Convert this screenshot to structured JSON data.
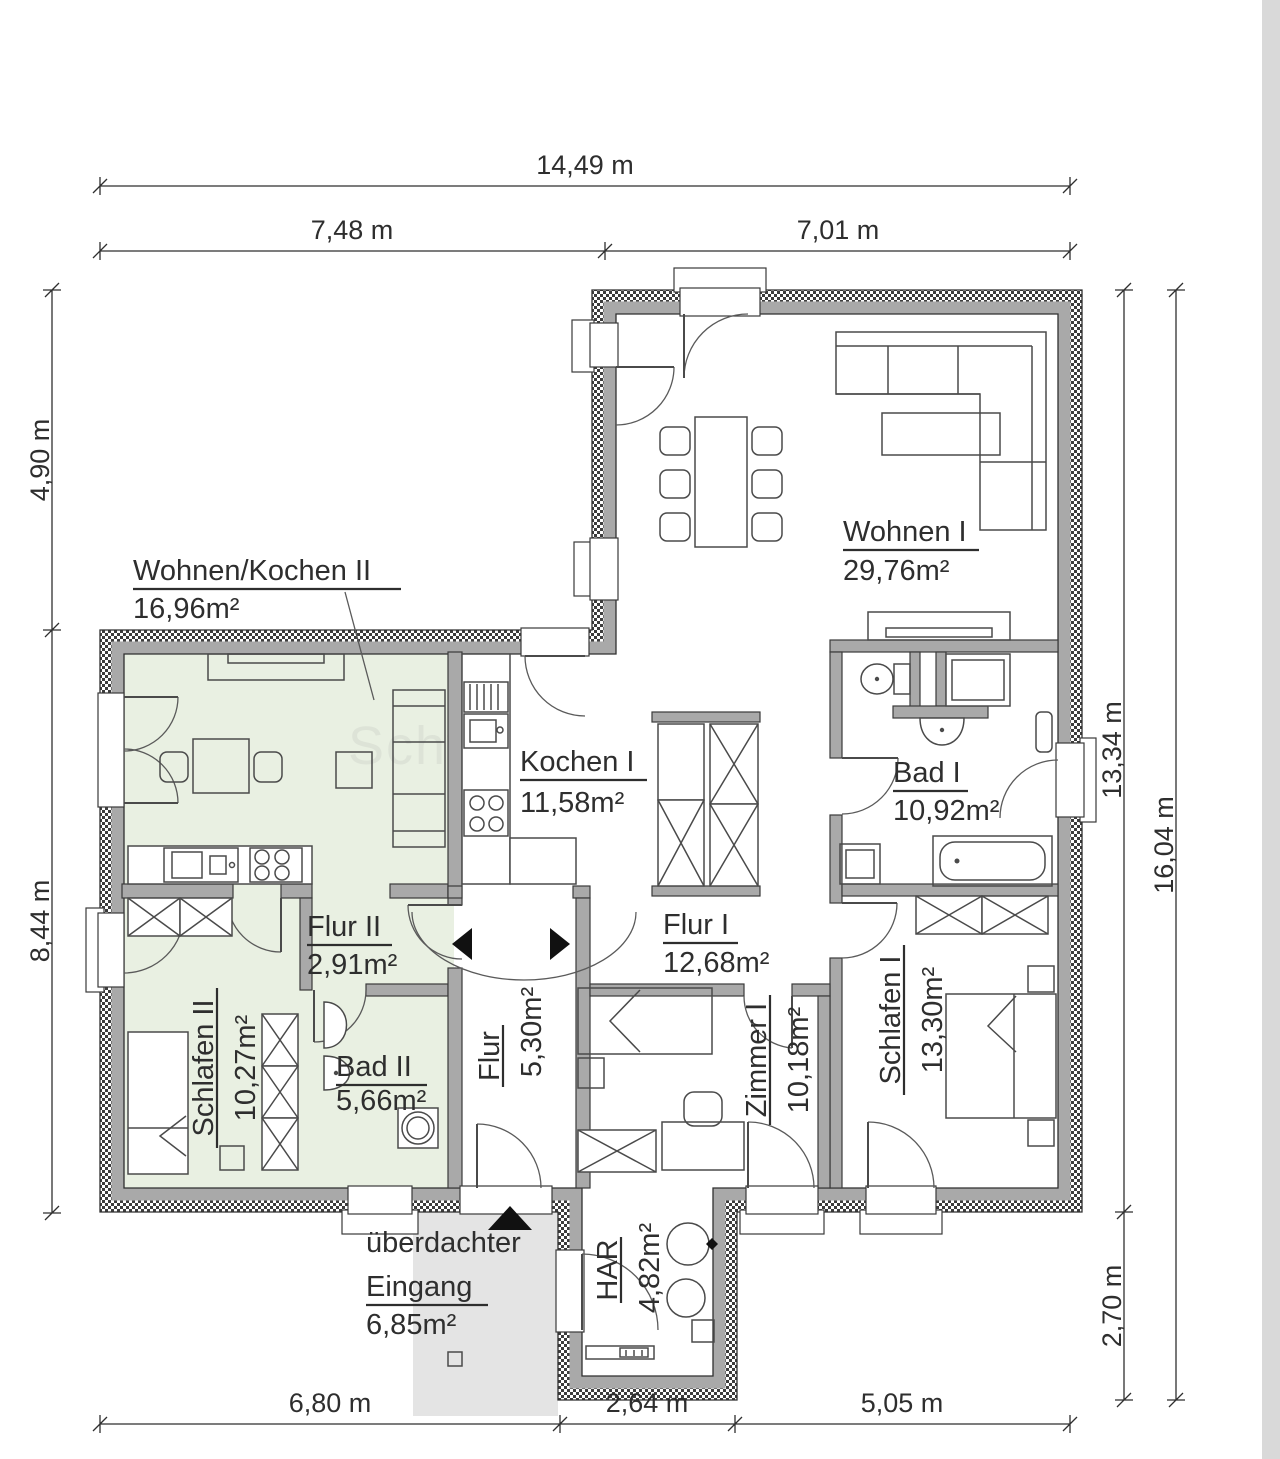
{
  "dimensions": {
    "top_total": "14,49 m",
    "top_left": "7,48 m",
    "top_right": "7,01 m",
    "left_upper": "4,90 m",
    "left_lower": "8,44 m",
    "right_main": "13,34 m",
    "right_lower": "2,70 m",
    "right_total": "16,04 m",
    "bottom_left": "6,80 m",
    "bottom_middle": "2,64 m",
    "bottom_right": "5,05 m"
  },
  "rooms": {
    "wohnen_kochen_2": {
      "name": "Wohnen/Kochen II",
      "area": "16,96m²"
    },
    "wohnen_1": {
      "name": "Wohnen I",
      "area": "29,76m²"
    },
    "kochen_1": {
      "name": "Kochen I",
      "area": "11,58m²"
    },
    "bad_1": {
      "name": "Bad I",
      "area": "10,92m²"
    },
    "flur_2": {
      "name": "Flur II",
      "area": "2,91m²"
    },
    "flur_1": {
      "name": "Flur I",
      "area": "12,68m²"
    },
    "schlafen_2": {
      "name": "Schlafen II",
      "area": "10,27m²"
    },
    "bad_2": {
      "name": "Bad II",
      "area": "5,66m²"
    },
    "flur": {
      "name": "Flur",
      "area": "5,30m²"
    },
    "zimmer_1": {
      "name": "Zimmer I",
      "area": "10,18m²"
    },
    "schlafen_1": {
      "name": "Schlafen I",
      "area": "13,30m²"
    },
    "har": {
      "name": "HAR",
      "area": "4,82m²"
    },
    "eingang": {
      "name_line1": "überdachter",
      "name_line2": "Eingang",
      "area": "6,85m²"
    }
  },
  "watermark": "Schw",
  "colors": {
    "unit2_fill": "#e9f0e2",
    "entrance_fill": "#e4e4e4",
    "right_strip": "#d9d9d9",
    "wall_gray": "#a9a9a9"
  }
}
